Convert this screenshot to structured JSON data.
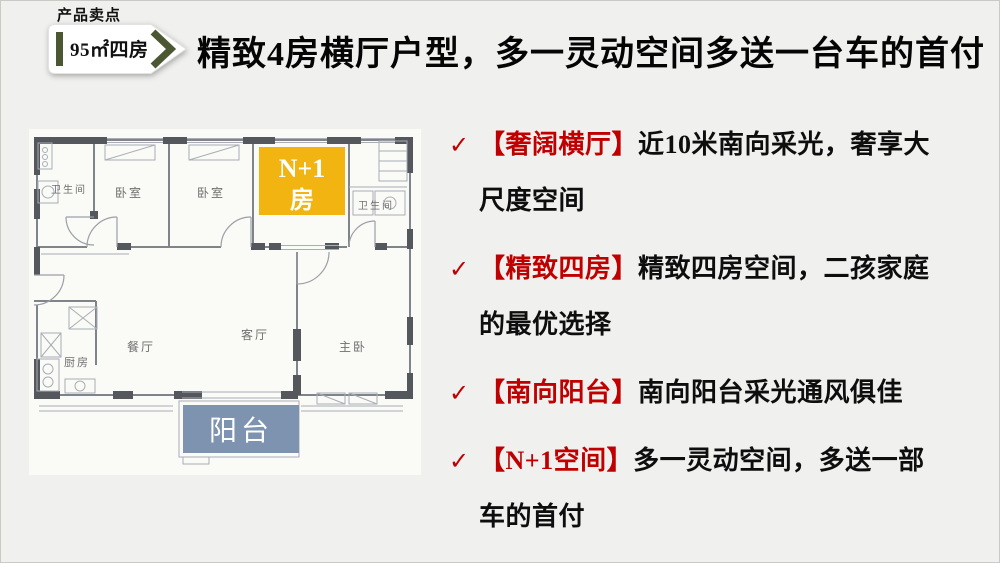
{
  "slide": {
    "eyebrow": "产品卖点",
    "badge": {
      "label": "95㎡四房",
      "accent": "#4b5733"
    },
    "title": "精致4房横厅户型，多一灵动空间多送一台车的首付"
  },
  "floor_plan": {
    "labels": {
      "bath_left": "卫生间",
      "bedroom1": "卧室",
      "bedroom2": "卧室",
      "bath_right": "卫生间",
      "kitchen": "厨房",
      "dining": "餐厅",
      "living": "客厅",
      "master": "主卧"
    },
    "highlight_room": {
      "line1": "N+1",
      "line2": "房",
      "fill": "#f2b411"
    },
    "balcony": {
      "label": "阳台",
      "fill": "#7d93af"
    }
  },
  "selling_points": {
    "check": "✓",
    "accent": "#c00000",
    "items": [
      {
        "tag": "【奢阔横厅】",
        "desc": "近10米南向采光，奢享大尺度空间"
      },
      {
        "tag": "【精致四房】",
        "desc": "精致四房空间，二孩家庭的最优选择"
      },
      {
        "tag": "【南向阳台】",
        "desc": "南向阳台采光通风俱佳"
      },
      {
        "tag": "【N+1空间】",
        "desc": "多一灵动空间，多送一部车的首付"
      }
    ]
  }
}
